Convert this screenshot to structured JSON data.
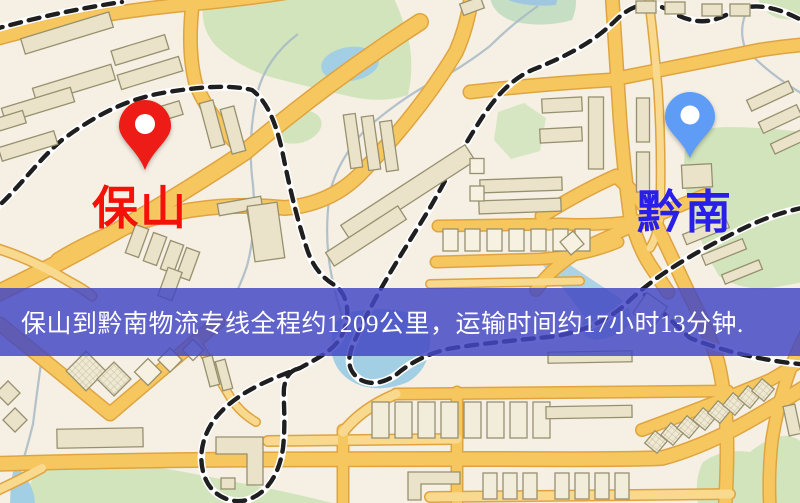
{
  "banner": {
    "text": "保山到黔南物流专线全程约1209公里，运输时间约17小时13分钟.",
    "background": "rgba(67,71,196,0.84)",
    "text_color": "#ffffff"
  },
  "markers": {
    "origin": {
      "label": "保山",
      "label_color": "#f51008",
      "pin": "red-pin",
      "pin_color": "#ee1c16"
    },
    "destination": {
      "label": "黔南",
      "label_color": "#2a1fe6",
      "pin": "blue-pin",
      "pin_color": "#5e9cf5"
    }
  },
  "map": {
    "colors": {
      "background": "#f5efe4",
      "road": "#f6c75e",
      "road_casing": "#dfa440",
      "minor_road": "#f8d98e",
      "railway_dash": "#1f1f1f",
      "railway_casing": "#ffffff",
      "water": "#a3cfe4",
      "park": "#d2e4bb",
      "building": "#ebe3c9",
      "building_outline": "#97906f"
    }
  }
}
